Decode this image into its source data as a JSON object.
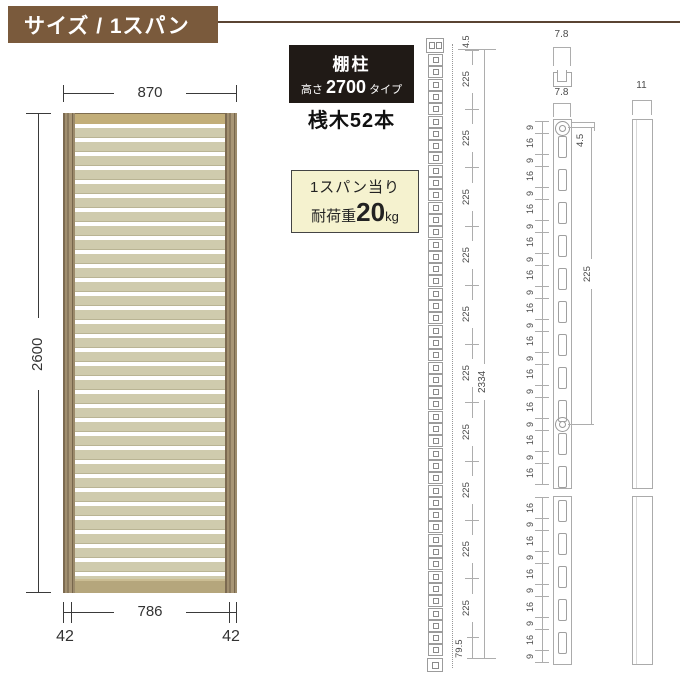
{
  "header": {
    "title": "サイズ / 1スパン"
  },
  "panel": {
    "top_width": "870",
    "height": "2600",
    "inner_width": "786",
    "edge_left": "42",
    "edge_right": "42"
  },
  "spec": {
    "name": "棚柱",
    "height_prefix": "高さ",
    "height_value": "2700",
    "height_suffix": "タイプ",
    "crosspieces": "桟木52本"
  },
  "load": {
    "line1": "1スパン当り",
    "prefix": "耐荷重",
    "value": "20",
    "unit": "kg"
  },
  "full_view": {
    "slot_count": 49,
    "top_offset": "4.5",
    "pitch_labels": [
      "225",
      "225",
      "225",
      "225",
      "225",
      "225",
      "225",
      "225",
      "225",
      "225"
    ],
    "bottom_offset": "79.5",
    "total": "2334"
  },
  "front_view": {
    "section_width": "7.8",
    "width": "7.8",
    "top_offset": "4.5",
    "hole_pitch": "225",
    "upper_segments": [
      "9",
      "16",
      "9",
      "16",
      "9",
      "16",
      "9",
      "16",
      "9",
      "16",
      "9",
      "16",
      "9",
      "16",
      "9",
      "16",
      "9",
      "16",
      "9",
      "16",
      "9",
      "16"
    ],
    "lower_segments": [
      "16",
      "9",
      "16",
      "9",
      "16",
      "9",
      "16",
      "9",
      "16",
      "9"
    ]
  },
  "side_view": {
    "width": "11"
  },
  "colors": {
    "header_bg": "#7a5a3c",
    "header_rule": "#5a4433",
    "panel_rail_top": "#c2ae79",
    "panel_rail_bottom": "#b5a67c",
    "panel_slat": "#cfcbad",
    "spec_box_bg": "#201a16",
    "load_box_bg": "#f5f2cf",
    "line_dark": "#3a3a3a",
    "line_light": "#adadad"
  }
}
